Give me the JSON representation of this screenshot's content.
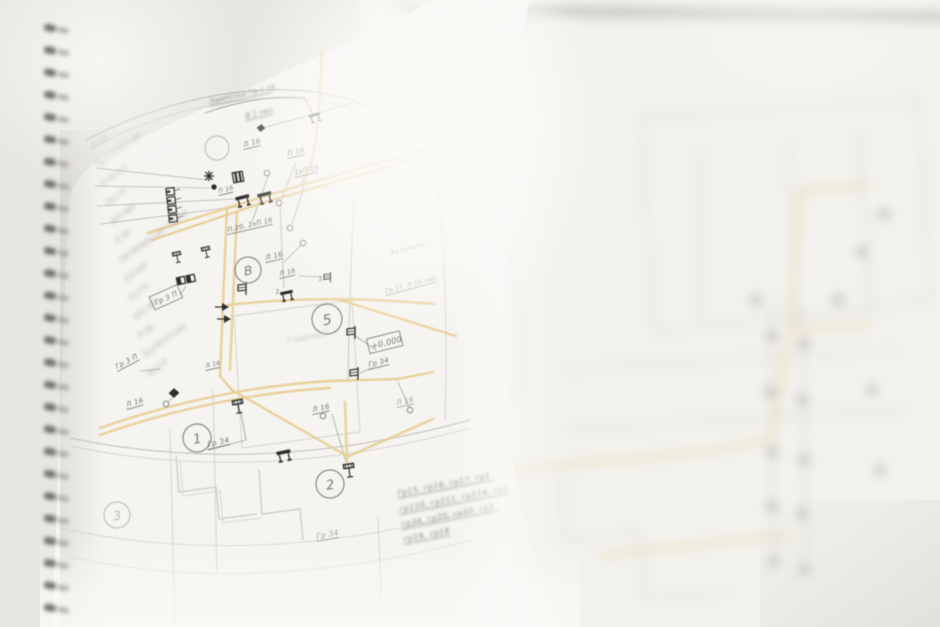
{
  "photo": {
    "description": "Close-up photograph of a spiral-bound notebook page showing an electrical wiring floor plan (Cyrillic annotations); left page in focus, right page and edges blurred",
    "colors": {
      "background": "#e8e6e2",
      "page": "#f5f4f1",
      "right_page": "#f2f1ed",
      "wire_yellow": "#e9d098",
      "line_gray": "#b2afa8",
      "line_faint": "#d2cfc9",
      "ink": "#76736d",
      "ink_faint": "#a6a39d",
      "symbol_black": "#2e2d2a",
      "spiral_coil": "#5f5d58"
    }
  },
  "drawing": {
    "title_note": {
      "line1": "Лампочки Гр.1 16",
      "line2": "В 1 нво"
    },
    "room_label": "Главный",
    "circle_markers": [
      {
        "t": "В",
        "x": 248,
        "y": 270,
        "r": 13,
        "faint": false
      },
      {
        "t": "5",
        "x": 327,
        "y": 319,
        "r": 15,
        "faint": false
      },
      {
        "t": "1",
        "x": 197,
        "y": 438,
        "r": 14,
        "faint": false
      },
      {
        "t": "2",
        "x": 330,
        "y": 484,
        "r": 14,
        "faint": false
      },
      {
        "t": "3",
        "x": 117,
        "y": 515,
        "r": 13,
        "faint": true
      },
      {
        "t": "",
        "x": 217,
        "y": 148,
        "r": 12,
        "faint": true
      }
    ],
    "boxed_labels": [
      {
        "t": "Гр 3 П",
        "x": 156,
        "y": 305,
        "rot": -24,
        "fz": 7
      },
      {
        "t": "+0.000",
        "x": 372,
        "y": 349,
        "rot": -14,
        "fz": 8
      }
    ],
    "labels": [
      {
        "t": "Л 16",
        "x": 244,
        "y": 147,
        "rot": -14,
        "fz": 7,
        "u": 1
      },
      {
        "t": "П 16",
        "x": 288,
        "y": 156,
        "rot": -14,
        "fz": 7,
        "u": 1
      },
      {
        "t": "2хП 16",
        "x": 295,
        "y": 175,
        "rot": -14,
        "fz": 6.5,
        "u": 1
      },
      {
        "t": "П 16",
        "x": 219,
        "y": 193,
        "rot": -14,
        "fz": 6,
        "u": 1
      },
      {
        "t": "П.20, 2хП 16",
        "x": 228,
        "y": 232,
        "rot": -13,
        "fz": 6.5,
        "u": 1
      },
      {
        "t": "Л 16",
        "x": 266,
        "y": 260,
        "rot": -13,
        "fz": 7,
        "u": 1
      },
      {
        "t": "Л 16",
        "x": 280,
        "y": 276,
        "rot": -13,
        "fz": 6.5,
        "u": 1
      },
      {
        "t": "2",
        "x": 276,
        "y": 294,
        "rot": -13,
        "fz": 6
      },
      {
        "t": "2",
        "x": 319,
        "y": 281,
        "rot": -13,
        "fz": 6
      },
      {
        "t": "Гр 3 П",
        "x": 117,
        "y": 369,
        "rot": -28,
        "fz": 7,
        "u": 1
      },
      {
        "t": "Л 16",
        "x": 206,
        "y": 368,
        "rot": -13,
        "fz": 6,
        "u": 1
      },
      {
        "t": "Л 16",
        "x": 127,
        "y": 407,
        "rot": -16,
        "fz": 7,
        "u": 1
      },
      {
        "t": "Л 16",
        "x": 313,
        "y": 412,
        "rot": -12,
        "fz": 7,
        "u": 1
      },
      {
        "t": "Л 16",
        "x": 397,
        "y": 405,
        "rot": -12,
        "fz": 7,
        "u": 1,
        "faint": 1
      },
      {
        "t": "Гр 34",
        "x": 208,
        "y": 447,
        "rot": -13,
        "fz": 7.5,
        "u": 1
      },
      {
        "t": "Гр 34",
        "x": 369,
        "y": 367,
        "rot": -14,
        "fz": 7,
        "u": 1
      },
      {
        "t": "Гр 34",
        "x": 317,
        "y": 539,
        "rot": -11,
        "fz": 7.5,
        "u": 1,
        "faint": 1
      },
      {
        "t": "Автоматы",
        "x": 391,
        "y": 255,
        "rot": -15,
        "fz": 6.5,
        "faint": 1
      },
      {
        "t": "Гр.17, П 16 нво",
        "x": 386,
        "y": 293,
        "rot": -15,
        "fz": 6,
        "u": 1,
        "faint": 1
      }
    ],
    "group_list_rows": [
      {
        "t": "Гр15, гр16, гр17, гр1",
        "x": 398,
        "y": 496
      },
      {
        "t": "гр110, гр111, гр119, гр1",
        "x": 400,
        "y": 512
      },
      {
        "t": "гр34, гр35, гр33, гр3",
        "x": 402,
        "y": 527
      },
      {
        "t": "гр19, гр18",
        "x": 404,
        "y": 542
      }
    ],
    "left_table_rows": [
      "П 16",
      "Гр.1 П  2х1 нво",
      "П 16  2,5",
      "Гр.1 П",
      "2х1 нво",
      "П 16",
      "Питающие нач. Гр.2 В",
      "2,5 нво",
      "Гр 3 П",
      "2х1 нво",
      "П 16",
      "Гр.2 В  2,5 нво",
      "Гр 3 П"
    ],
    "symbols": [
      {
        "s": "ttable",
        "x": 243,
        "y": 200,
        "rot": -14
      },
      {
        "s": "ttable",
        "x": 265,
        "y": 197,
        "rot": -14
      },
      {
        "s": "ttable",
        "x": 315,
        "y": 117,
        "rot": -16,
        "sc": 0.8
      },
      {
        "s": "para",
        "x": 261,
        "y": 128,
        "rot": -16,
        "sc": 0.8
      },
      {
        "s": "ladder",
        "x": 172,
        "y": 208,
        "rot": -6
      },
      {
        "s": "asterisk",
        "x": 209,
        "y": 176
      },
      {
        "s": "dot",
        "x": 214,
        "y": 187
      },
      {
        "s": "grid",
        "x": 238,
        "y": 177,
        "rot": -10
      },
      {
        "s": "lamp",
        "x": 177,
        "y": 256,
        "rot": -12,
        "sc": 0.8
      },
      {
        "s": "lamp",
        "x": 206,
        "y": 251,
        "rot": -12,
        "sc": 0.8
      },
      {
        "s": "dblsq",
        "x": 186,
        "y": 280,
        "rot": -12
      },
      {
        "s": "flag",
        "x": 243,
        "y": 288
      },
      {
        "s": "wedge",
        "x": 222,
        "y": 307
      },
      {
        "s": "wedge",
        "x": 224,
        "y": 319
      },
      {
        "s": "ttable",
        "x": 287,
        "y": 295,
        "rot": -12,
        "sc": 0.9
      },
      {
        "s": "flag",
        "x": 328,
        "y": 277,
        "sc": 0.8
      },
      {
        "s": "flag",
        "x": 352,
        "y": 332
      },
      {
        "s": "flag",
        "x": 355,
        "y": 373
      },
      {
        "s": "para",
        "x": 174,
        "y": 393,
        "rot": -24
      },
      {
        "s": "lamp",
        "x": 238,
        "y": 405,
        "rot": -10
      },
      {
        "s": "ttable",
        "x": 284,
        "y": 455,
        "rot": -12
      },
      {
        "s": "lamp",
        "x": 349,
        "y": 469,
        "rot": -8
      }
    ],
    "node_circles": [
      [
        267,
        173
      ],
      [
        279,
        203
      ],
      [
        290,
        228
      ],
      [
        303,
        243
      ],
      [
        166,
        404
      ],
      [
        410,
        410
      ],
      [
        323,
        416
      ]
    ],
    "right_page_dots": [
      [
        772,
        336
      ],
      [
        804,
        344
      ],
      [
        770,
        392
      ],
      [
        802,
        400
      ],
      [
        772,
        452
      ],
      [
        804,
        460
      ],
      [
        772,
        506
      ],
      [
        802,
        514
      ],
      [
        774,
        562
      ],
      [
        804,
        570
      ],
      [
        838,
        300
      ],
      [
        862,
        252
      ],
      [
        884,
        214
      ],
      [
        756,
        300
      ],
      [
        872,
        390
      ],
      [
        880,
        470
      ]
    ]
  }
}
